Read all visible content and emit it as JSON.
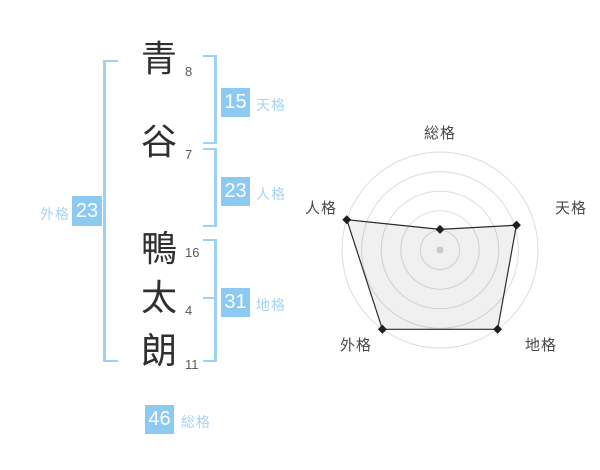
{
  "name_panel": {
    "characters": [
      {
        "char": "青",
        "strokes": "8"
      },
      {
        "char": "谷",
        "strokes": "7"
      },
      {
        "char": "鴨",
        "strokes": "16"
      },
      {
        "char": "太",
        "strokes": "4"
      },
      {
        "char": "朗",
        "strokes": "11"
      }
    ],
    "results": {
      "tenkaku": {
        "label": "天格",
        "value": "15"
      },
      "jinkaku": {
        "label": "人格",
        "value": "23"
      },
      "chikaku": {
        "label": "地格",
        "value": "31"
      },
      "gaikaku": {
        "label": "外格",
        "value": "23"
      },
      "soukaku": {
        "label": "総格",
        "value": "46"
      }
    }
  },
  "colors": {
    "accent_blue": "#8ccaf1",
    "accent_blue_text": "#a6d3f1",
    "bracket_blue": "#9cd1f3",
    "text_dark": "#2f2f2f",
    "stroke_count": "#5a5a5a",
    "ring": "#dcdcdc",
    "polygon_fill": "rgba(0,0,0,0.06)",
    "polygon_stroke": "#2b2b2b",
    "marker": "#1f1f1f",
    "center_dot": "#c9c9c9",
    "axis_label": "#4a4a4a"
  },
  "chart_data": {
    "type": "radar",
    "title": "",
    "axes": [
      "総格",
      "天格",
      "地格",
      "外格",
      "人格"
    ],
    "axes_order": "clockwise-from-top",
    "values": [
      46,
      15,
      31,
      23,
      23
    ],
    "values_percent": [
      21,
      82,
      100,
      100,
      100
    ],
    "max_percent": 100,
    "rings": 5,
    "grid": "concentric-circles",
    "legend": "none",
    "tick_labels": "none"
  }
}
